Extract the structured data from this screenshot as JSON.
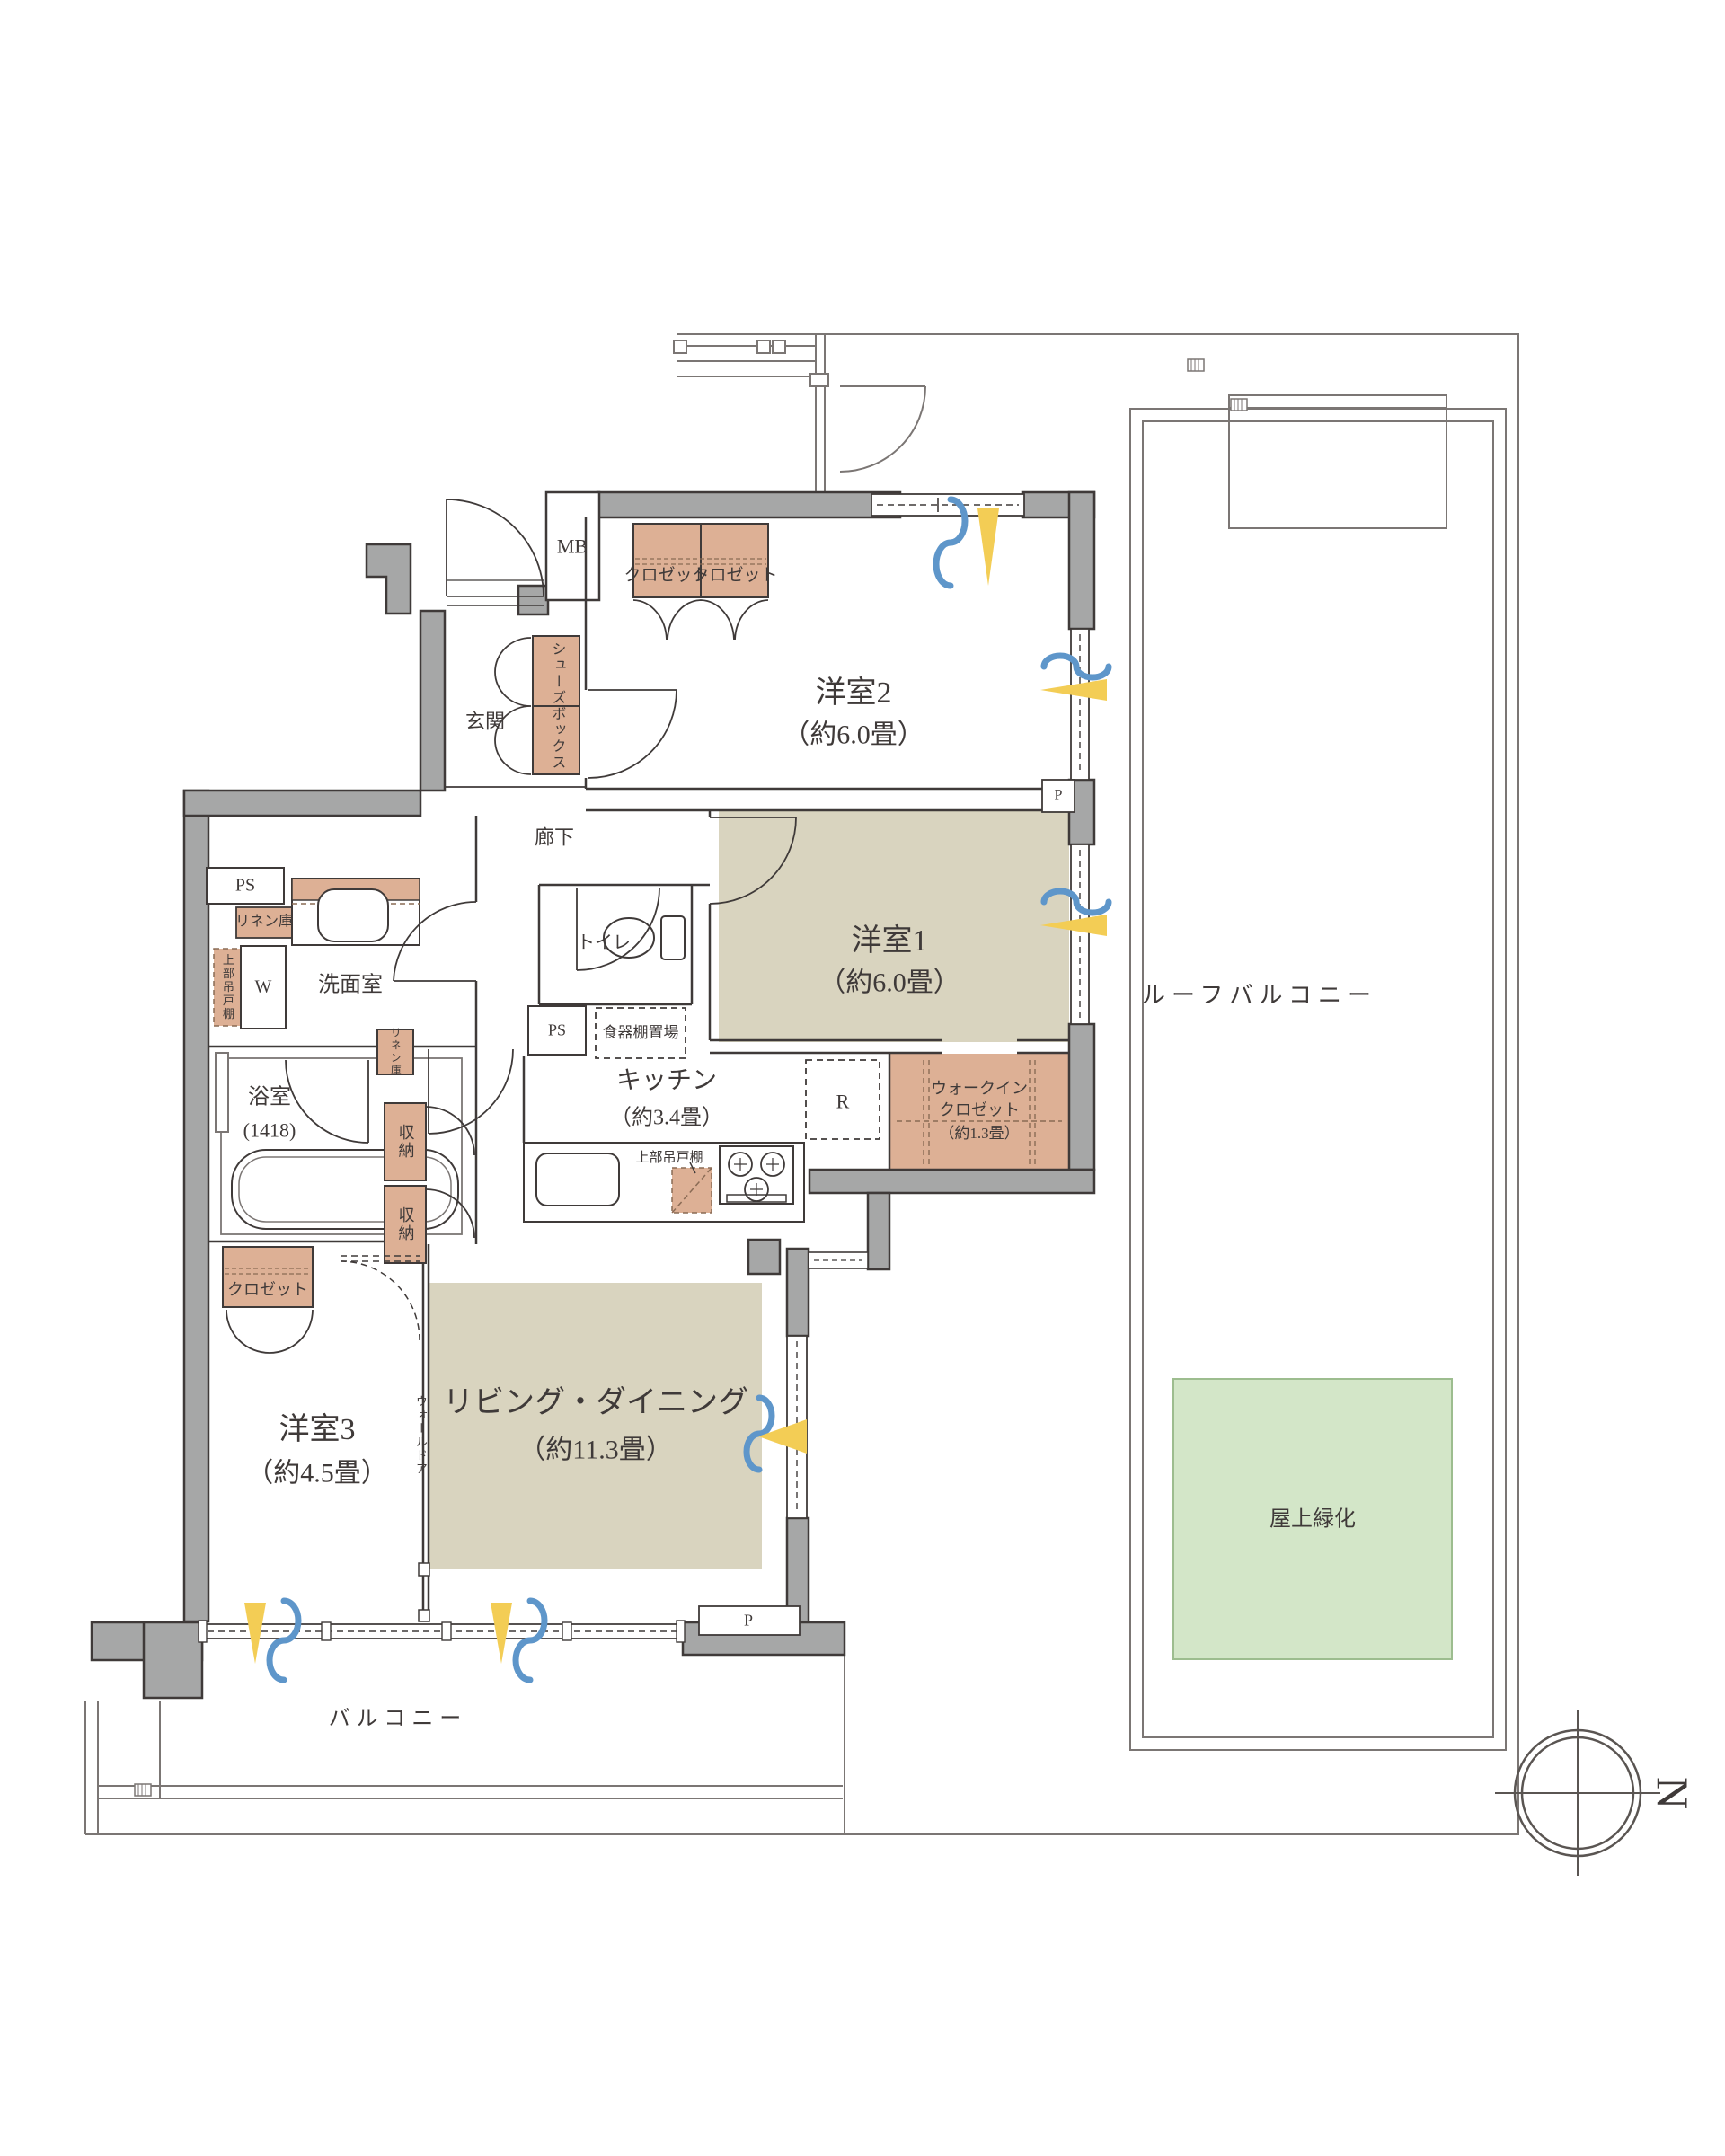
{
  "labels": {
    "mb": "MB",
    "closet": "クロゼット",
    "genkan": "玄関",
    "shoes_box": "シューズボックス",
    "rouka": "廊下",
    "yoshitsu2": "洋室2",
    "yoshitsu2_size": "（約6.0畳）",
    "yoshitsu1": "洋室1",
    "yoshitsu1_size": "（約6.0畳）",
    "roof_balcony": "ルーフバルコニー",
    "ps": "PS",
    "linen": "リネン庫",
    "upper_cabinet": "上部吊戸棚",
    "w": "W",
    "senmenshitsu": "洗面室",
    "toilet": "トイレ",
    "bath": "浴室",
    "bath_size": "(1418)",
    "shunou": "収納",
    "kitchen": "キッチン",
    "kitchen_size": "（約3.4畳）",
    "dish_shelf": "食器棚置場",
    "r": "R",
    "wic_line1": "ウォークイン",
    "wic_line2": "クロゼット",
    "wic_line3": "（約1.3畳）",
    "living": "リビング・ダイニング",
    "living_size": "（約11.3畳）",
    "wall_door": "ウォールドア",
    "yoshitsu3": "洋室3",
    "yoshitsu3_size": "（約4.5畳）",
    "balcony": "バルコニー",
    "green_roof": "屋上緑化",
    "p": "P",
    "north": "N"
  },
  "colors": {
    "wall_fill": "#a6a7a7",
    "wall_stroke": "#3f3a39",
    "floor_beige": "#d9d4bf",
    "storage_fill": "#ddb095",
    "green_fill": "#d3e6c8",
    "window_yellow": "#f3cd55",
    "wind_blue": "#5e96ca",
    "thin_line": "#7b7674"
  }
}
